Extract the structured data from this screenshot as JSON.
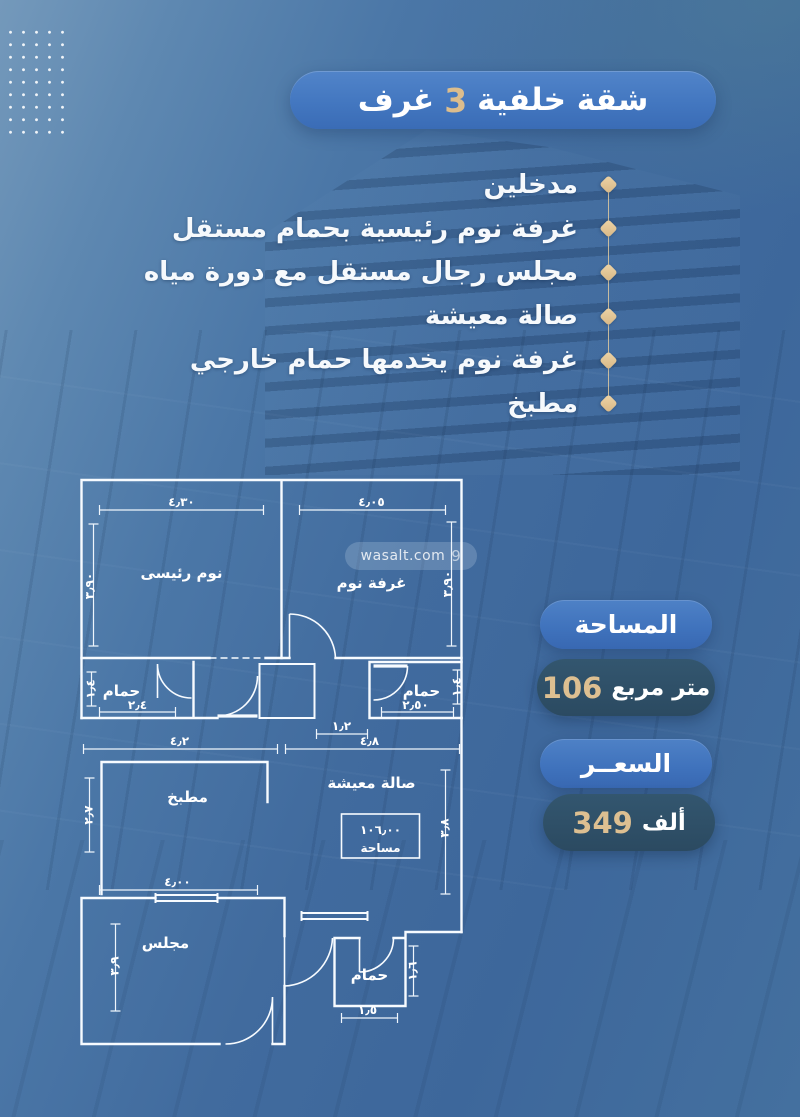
{
  "header": {
    "prefix": "شقة خلفية",
    "number": "3",
    "suffix": "غرف"
  },
  "features": {
    "items": [
      "مدخلين",
      "غرفة نوم رئيسية بحمام مستقل",
      "مجلس رجال مستقل مع دورة مياه",
      "صالة معيشة",
      "غرفة نوم يخدمها حمام خارجي",
      "مطبخ"
    ]
  },
  "watermark": {
    "text": "wasalt.com",
    "logo": "9"
  },
  "area_card": {
    "title": "المساحة",
    "value": "106",
    "unit": "متر مربع"
  },
  "price_card": {
    "title": "السعــر",
    "value": "349",
    "unit": "ألف"
  },
  "plan": {
    "master_bedroom": {
      "label": "نوم رئيسى",
      "width": "٤٫٣٠",
      "height": "٣٫٩٠"
    },
    "bedroom": {
      "label": "غرفة نوم",
      "width": "٤٫٠٥",
      "height": "٣٫٩٠"
    },
    "bath_left": {
      "label": "حمام",
      "width": "٢٫٤",
      "height": "١٫٤"
    },
    "bath_right": {
      "label": "حمام",
      "width": "٢٫٥٠",
      "height": "١٫٤"
    },
    "corridor_width": "١٫٢",
    "overall_left": "٤٫٢",
    "overall_right": "٤٫٨",
    "kitchen": {
      "label": "مطبخ",
      "height": "٢٫٧"
    },
    "living": {
      "label": "صالة معيشة",
      "area_value": "١٠٦٫٠٠",
      "area_word": "مساحة",
      "height": "٣٫٨"
    },
    "majlis": {
      "label": "مجلس",
      "width": "٤٫٠٠",
      "height": "٣٫٩"
    },
    "bath_bottom": {
      "label": "حمام",
      "width": "١٫٥",
      "height": "١٫٦"
    }
  },
  "colors": {
    "accent_gold": "#ddbf91",
    "header_blue": "#4377c0",
    "dark_pill": "#2e4f68",
    "plan_lines": "#f7fbff"
  }
}
